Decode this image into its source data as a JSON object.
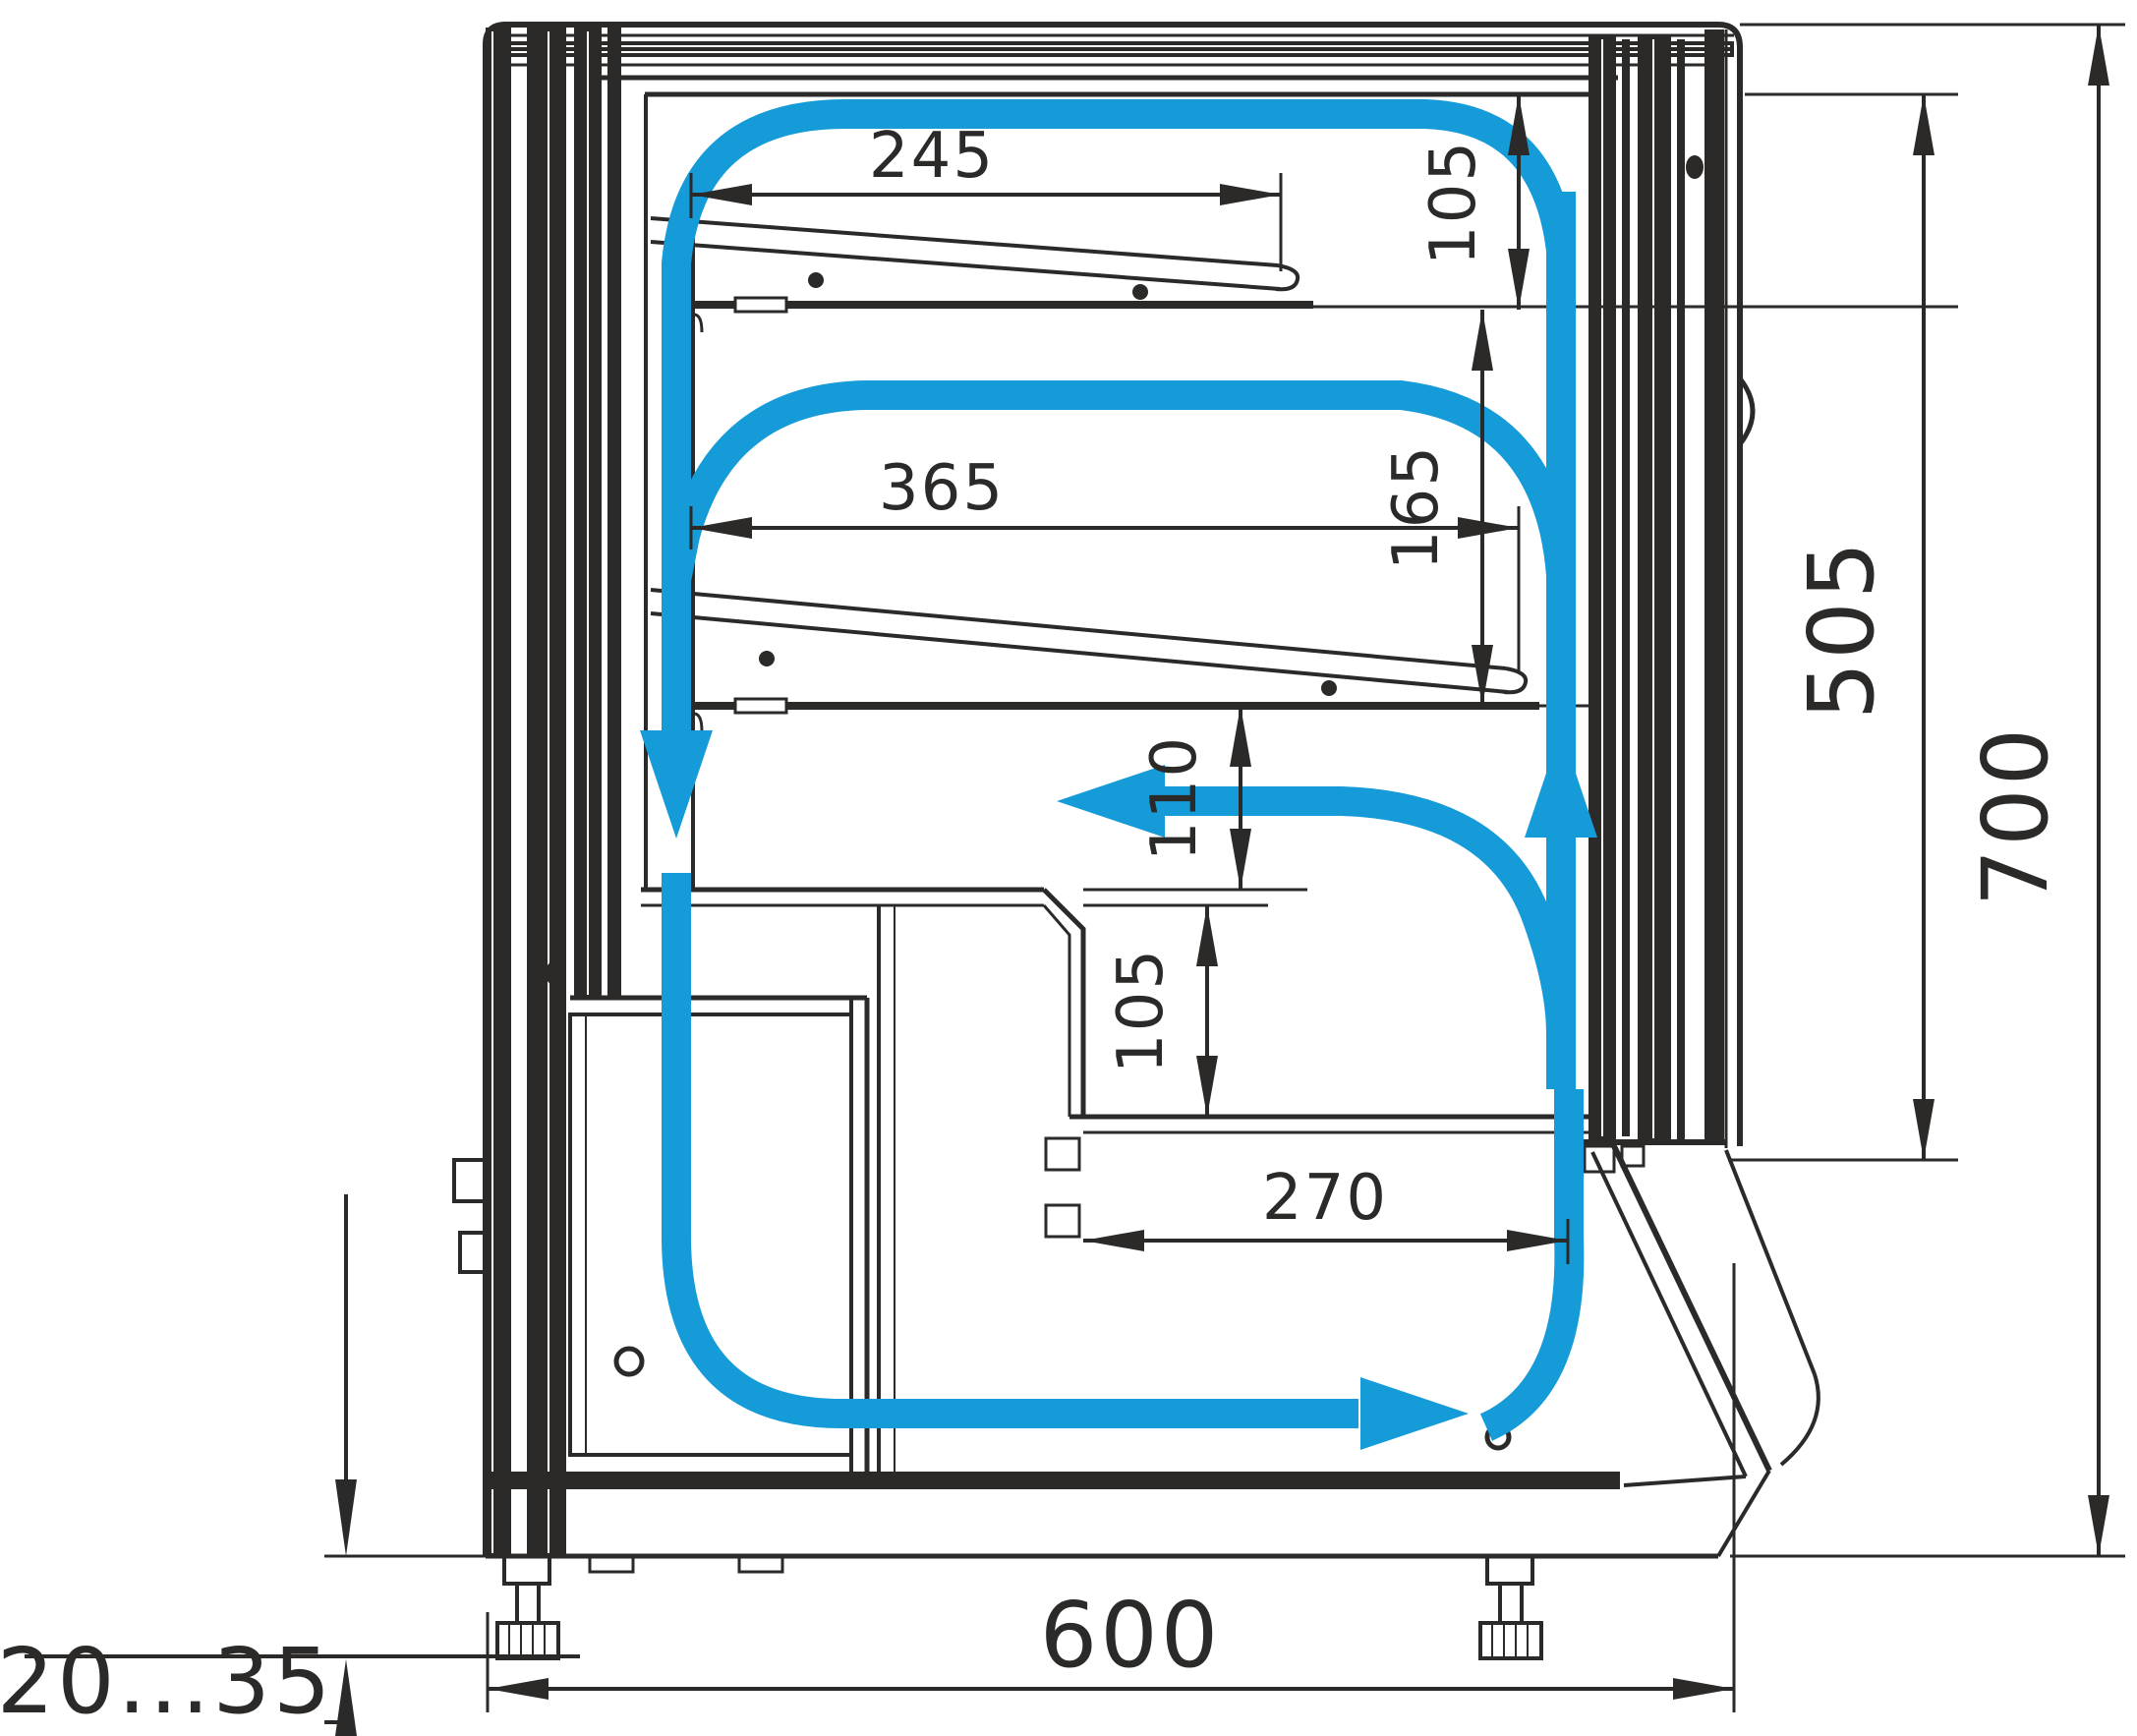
{
  "diagram": {
    "title": "Refrigerated display case side cross-section with air circulation",
    "units": "mm",
    "colors": {
      "line": "#2b2a29",
      "airflow": "#169bd9",
      "background": "#ffffff"
    },
    "dimensions": {
      "top_shelf_depth": "245",
      "middle_shelf_depth": "365",
      "top_clearance": "105",
      "shelf_clearance": "165",
      "bottom_clearance": "110",
      "well_height": "105",
      "well_depth": "270",
      "inner_front_height": "505",
      "overall_height": "700",
      "overall_depth": "600",
      "leg_adjustment_range": "20...35"
    },
    "airflow": {
      "description": "Closed cold-air loop: air rises in front glass channel, branches left over each shelf level, descends rear duct, returns along the base well",
      "branch_count": 3
    }
  }
}
